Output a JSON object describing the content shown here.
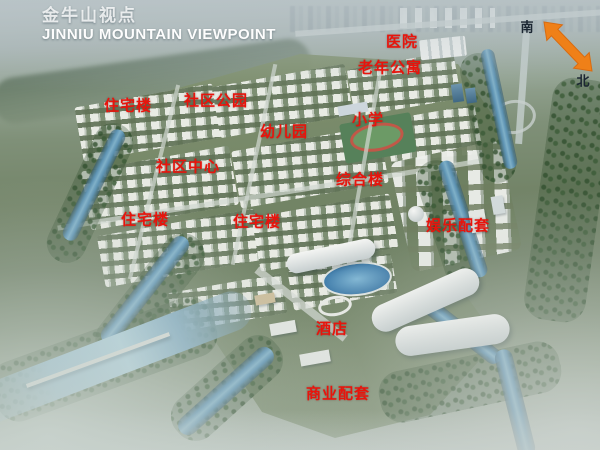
{
  "title": {
    "zh": "金牛山视点",
    "en": "JINNIU MOUNTAIN VIEWPOINT"
  },
  "compass": {
    "south": "南",
    "north": "北"
  },
  "map_labels": [
    {
      "text": "医院",
      "x": 402,
      "y": 41
    },
    {
      "text": "老年公寓",
      "x": 390,
      "y": 67
    },
    {
      "text": "住宅楼",
      "x": 128,
      "y": 105
    },
    {
      "text": "社区公园",
      "x": 216,
      "y": 100
    },
    {
      "text": "小学",
      "x": 368,
      "y": 119
    },
    {
      "text": "幼儿园",
      "x": 284,
      "y": 131
    },
    {
      "text": "社区中心",
      "x": 188,
      "y": 166
    },
    {
      "text": "综合楼",
      "x": 360,
      "y": 179
    },
    {
      "text": "住宅楼",
      "x": 145,
      "y": 219
    },
    {
      "text": "住宅楼",
      "x": 257,
      "y": 221
    },
    {
      "text": "娱乐配套",
      "x": 458,
      "y": 225
    },
    {
      "text": "酒店",
      "x": 332,
      "y": 328
    },
    {
      "text": "商业配套",
      "x": 338,
      "y": 393
    }
  ],
  "colors": {
    "label_red": "#e8140c",
    "compass_orange": "#ef8018",
    "title_white": "#ffffff"
  }
}
